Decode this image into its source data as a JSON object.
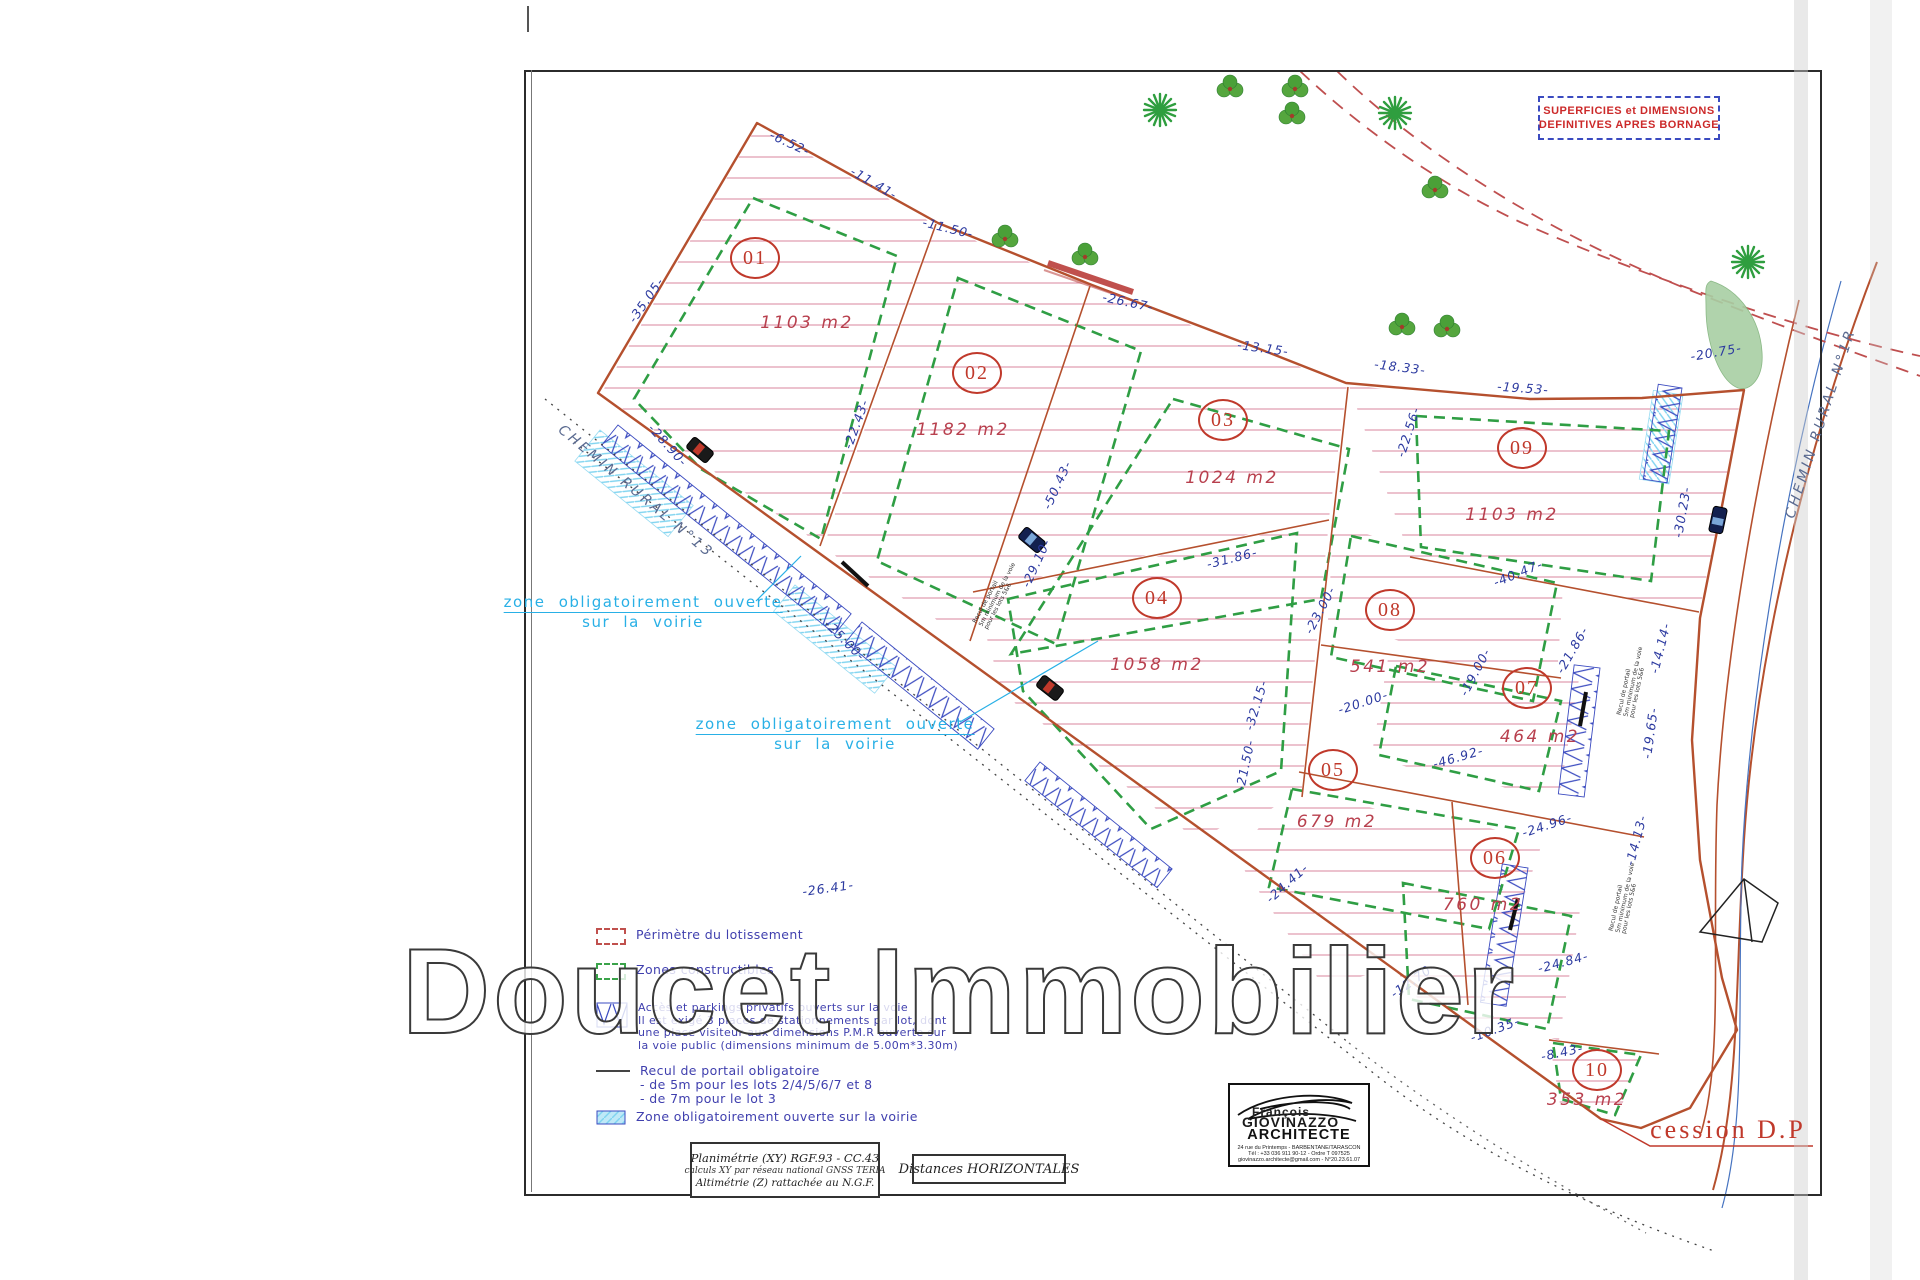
{
  "watermark": "Doucet Immobilier",
  "corner_box": {
    "line1": "SUPERFICIES et DIMENSIONS",
    "line2": "DEFINITIVES APRES BORNAGE"
  },
  "roads": {
    "left": "CHEMIN RURAL N°13",
    "right": "CHEMIN RURAL N°1R"
  },
  "open_zone_label": {
    "line1": "zone obligatoirement ouverte",
    "line2": "sur la voirie"
  },
  "cession_label": "cession D.P",
  "lots": [
    {
      "num": "01",
      "area": "1103 m2"
    },
    {
      "num": "02",
      "area": "1182 m2"
    },
    {
      "num": "03",
      "area": "1024 m2"
    },
    {
      "num": "04",
      "area": "1058 m2"
    },
    {
      "num": "05",
      "area": "679 m2"
    },
    {
      "num": "06",
      "area": "760 m2"
    },
    {
      "num": "07",
      "area": "464 m2"
    },
    {
      "num": "08",
      "area": "541 m2"
    },
    {
      "num": "09",
      "area": "1103 m2"
    },
    {
      "num": "10",
      "area": "353 m2"
    }
  ],
  "dims": [
    "-6.52-",
    "-11.41-",
    "-11.50-",
    "-26.67-",
    "-13.15-",
    "-18.33-",
    "-19.53-",
    "-20.75-",
    "-35.05-",
    "-22.43-",
    "-28.90-",
    "-50.43-",
    "-29.10-",
    "-22.56-",
    "-30.23-",
    "-40.47-",
    "-31.86-",
    "-23.00-",
    "-32.15-",
    "-21.50-",
    "-20.00-",
    "-46.92-",
    "-19.00-",
    "-21.86-",
    "-14.14-",
    "-19.65-",
    "-24.96-",
    "-14.13-",
    "-24.41-",
    "-26.41-",
    "-24.84-",
    "-12.70-",
    "-10.35-",
    "-8.43-",
    "-25.00-"
  ],
  "micro_note": {
    "line1": "Recul de portail",
    "line2": "5m minimum de la voie",
    "line3": "pour les lots 5&6"
  },
  "legend": {
    "perimetre": "Périmètre du lotissement",
    "zones": "Zones constructibles",
    "access_lines": [
      "Accès et parkings privatifs ouverts sur la voie",
      "Il est exigé 3 places de stationnements par lot, dont",
      "une place visiteur aux dimensions P.M.R ouverte sur",
      "la voie public (dimensions minimum de 5.00m*3.30m)"
    ],
    "recul_lines": [
      "Recul de portail obligatoire",
      "- de 5m pour les lots 2/4/5/6/7 et 8",
      "- de 7m pour le lot 3"
    ],
    "zone_ouverte": "Zone obligatoirement ouverte sur la voirie"
  },
  "footer": {
    "plani_lines": [
      "Planimétrie (XY) RGF.93 - CC.43",
      "calculs XY par réseau national GNSS TERIA",
      "Altimétrie (Z) rattachée au N.G.F."
    ],
    "distances": "Distances HORIZONTALES"
  },
  "stamp": {
    "name1": "François",
    "name2": "GIOVINAZZO",
    "title": "ARCHITECTE",
    "addr1": "24 rue du Printemps - BARBENTANE/TARASCON",
    "addr2": "Tél : +33 036 911 90-12 - Ordre T 097525",
    "addr3": "giovinazzo.architecte@gmail.com - N°20.23.61.07"
  },
  "colors": {
    "perimeter_red": "#b5502e",
    "constructible_green": "#2f9e44",
    "dimension_blue": "#2c3aa0",
    "lot_red": "#c0392b",
    "open_zone_cyan": "#29b0e6",
    "hatch_pink": "#d8849c"
  }
}
